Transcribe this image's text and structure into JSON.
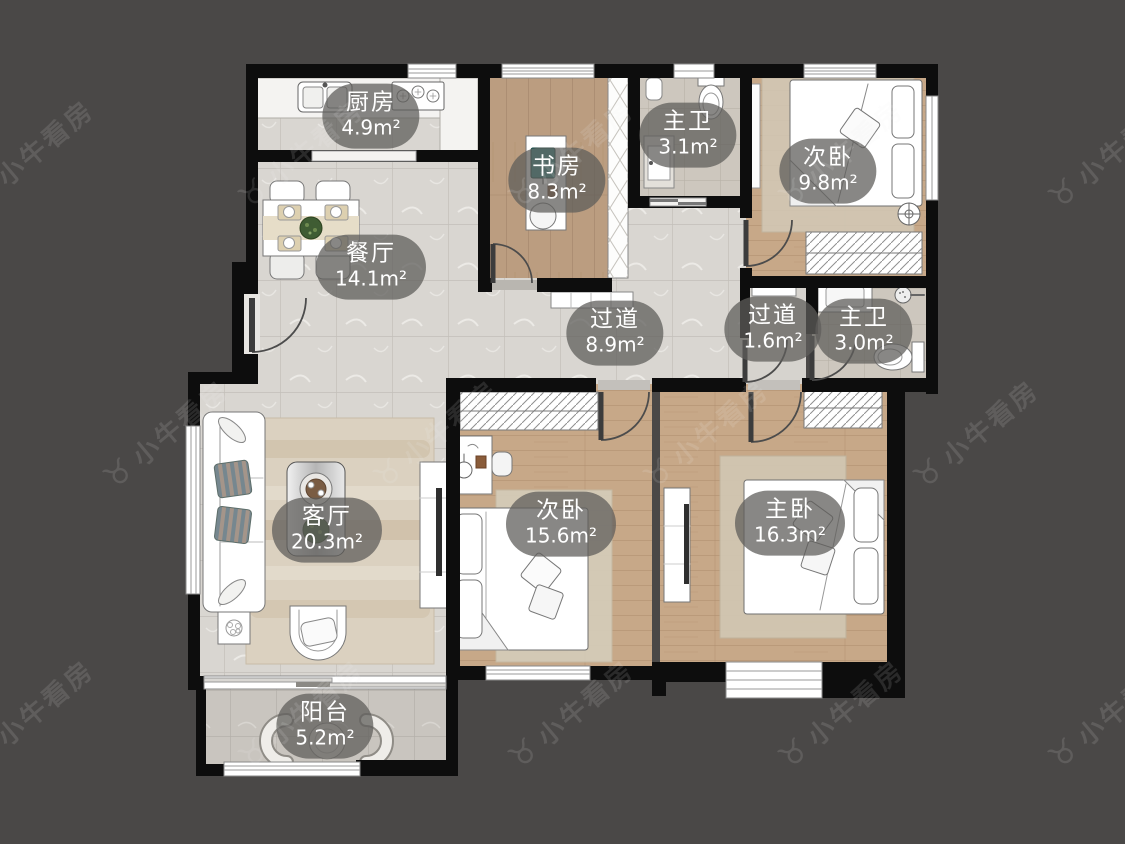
{
  "watermark": {
    "text": "小牛看房",
    "logo_glyph": "♉",
    "icon": "bull-logo-icon"
  },
  "rooms": [
    {
      "id": "kitchen",
      "name": "厨房",
      "area": "4.9m²"
    },
    {
      "id": "study",
      "name": "书房",
      "area": "8.3m²"
    },
    {
      "id": "bath-top",
      "name": "主卫",
      "area": "3.1m²"
    },
    {
      "id": "bedroom-top",
      "name": "次卧",
      "area": "9.8m²"
    },
    {
      "id": "dining",
      "name": "餐厅",
      "area": "14.1m²"
    },
    {
      "id": "hallway",
      "name": "过道",
      "area": "8.9m²"
    },
    {
      "id": "corridor",
      "name": "过道",
      "area": "1.6m²"
    },
    {
      "id": "bath-right",
      "name": "主卫",
      "area": "3.0m²"
    },
    {
      "id": "living",
      "name": "客厅",
      "area": "20.3m²"
    },
    {
      "id": "bedroom-middle",
      "name": "次卧",
      "area": "15.6m²"
    },
    {
      "id": "master-bedroom",
      "name": "主卧",
      "area": "16.3m²"
    },
    {
      "id": "balcony",
      "name": "阳台",
      "area": "5.2m²"
    }
  ],
  "colors": {
    "background": "#4a4847",
    "wall": "#0d0d0d",
    "label_pill": "#5f5d5a",
    "label_text": "#ffffff",
    "tile_floor": "#d9d6d1",
    "wood_floor": "#c7a888",
    "bath_tile": "#cdc7be",
    "monitor_teal": "#2e8b86"
  }
}
